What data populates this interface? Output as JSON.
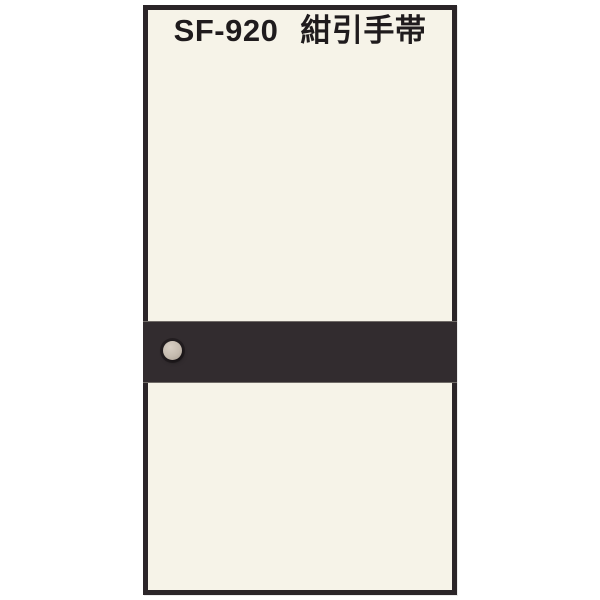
{
  "product": {
    "code": "SF-920",
    "name": "紺引手帯"
  },
  "colors": {
    "page-bg": "#ffffff",
    "card-bg": "#f6f3e8",
    "card-border": "#2b2528",
    "band": "#322c2f",
    "grommet": "#c5bbaf",
    "title-text": "#1f1b1d"
  }
}
